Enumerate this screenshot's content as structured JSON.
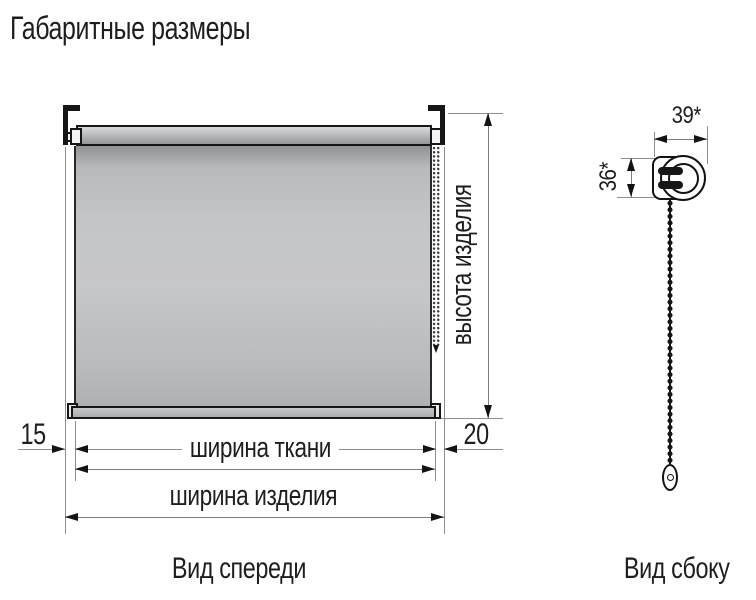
{
  "title": "Габаритные размеры",
  "front_view": {
    "caption": "Вид спереди",
    "labels": {
      "height": "высота изделия",
      "fabric_width": "ширина ткани",
      "product_width": "ширина изделия",
      "left_offset_mm": "15",
      "right_offset_mm": "20"
    }
  },
  "side_view": {
    "caption": "Вид сбоку",
    "labels": {
      "bracket_width_mm": "39*",
      "bracket_height_mm": "36*"
    }
  },
  "colors": {
    "background": "#ffffff",
    "drawing_line": "#8e8e8e",
    "ink": "#161616",
    "fabric_gray": "#c3c4c6"
  }
}
